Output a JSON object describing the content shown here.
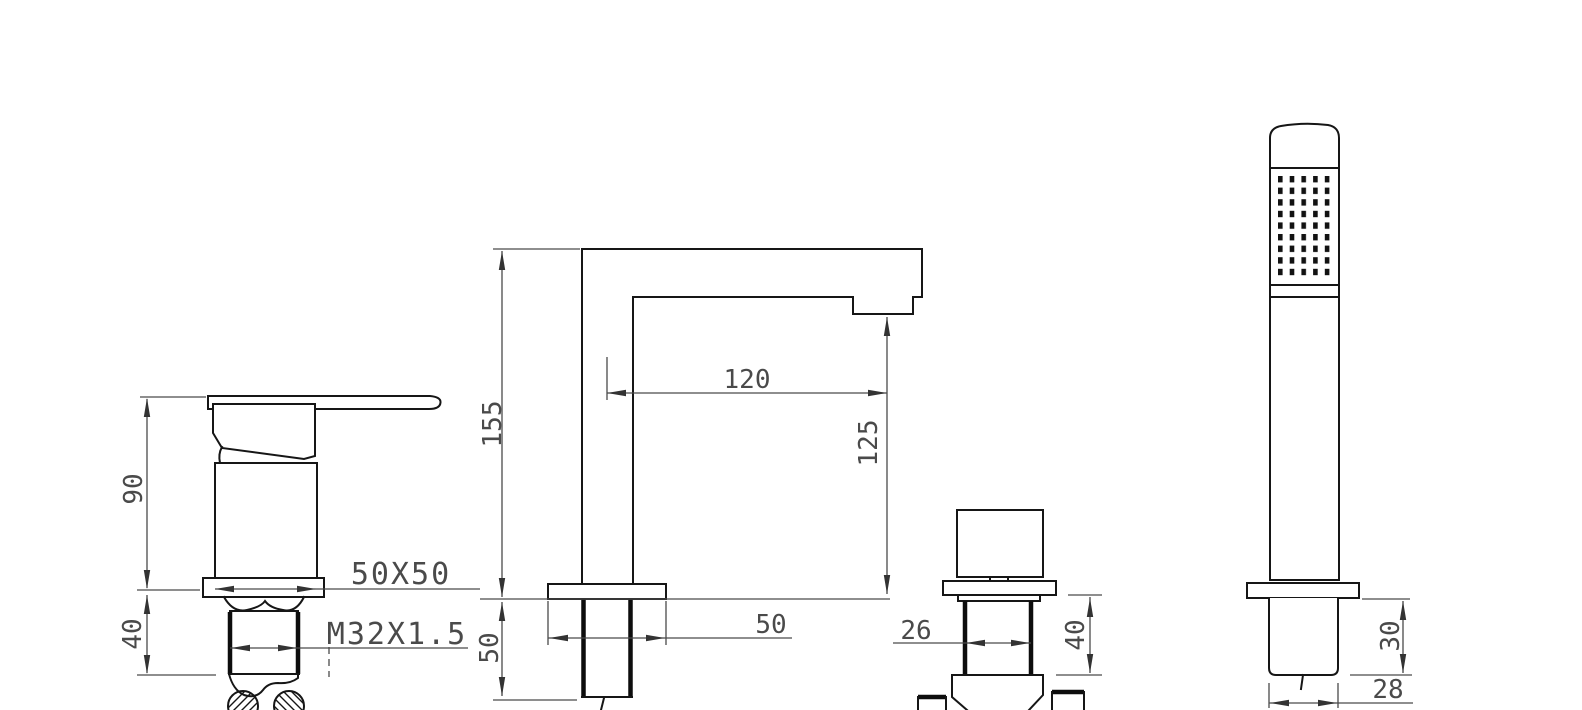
{
  "drawing": {
    "type": "technical-drawing",
    "subject": "bath-mixer-faucet-set-front-views",
    "background": "#ffffff",
    "line_color": "#161616",
    "dimension_color": "#4a4a4a",
    "components": {
      "mixer": {
        "body_height": "90",
        "thread_length": "40",
        "base_size_label": "50X50",
        "thread_spec_label": "M32X1.5"
      },
      "spout": {
        "overall_height": "155",
        "reach": "120",
        "outlet_height": "125",
        "shank_length": "50",
        "base_width": "50"
      },
      "diverter": {
        "body_width": "26",
        "shank_length": "40"
      },
      "hand_shower": {
        "shank_length": "30",
        "shank_width": "28"
      }
    }
  }
}
